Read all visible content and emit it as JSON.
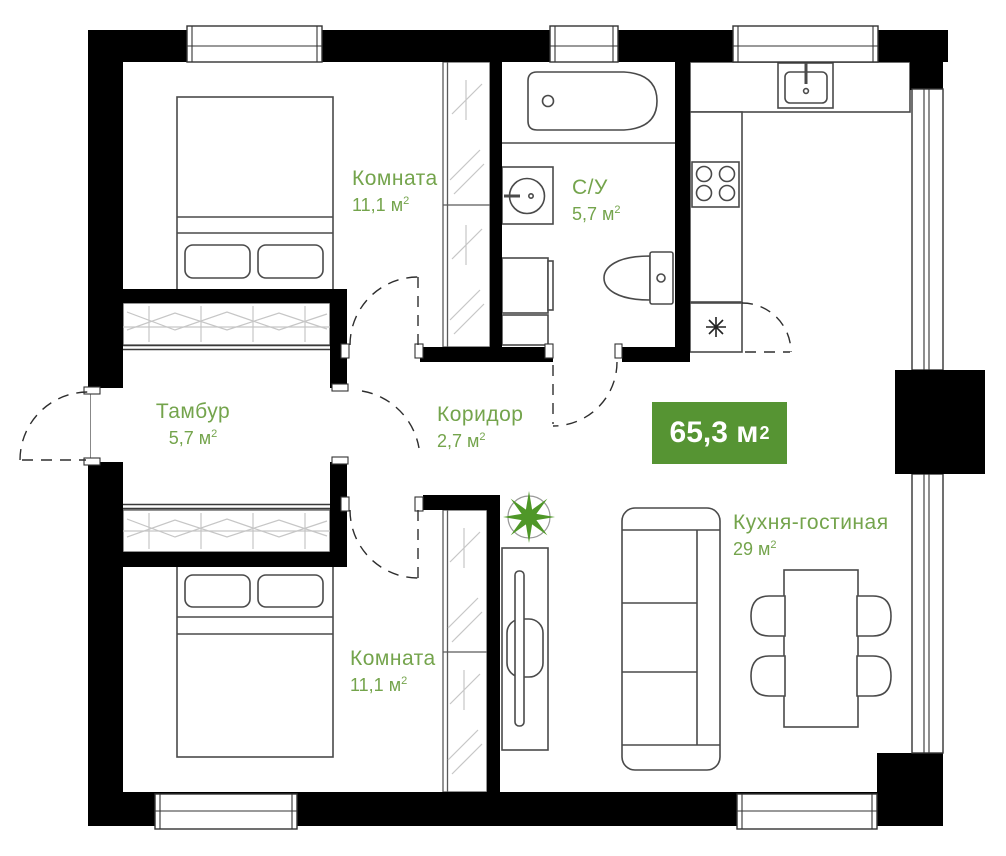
{
  "plan": {
    "title": "apartment-floor-plan",
    "total_area_badge": {
      "value": "65,3 м",
      "sup": "2"
    },
    "rooms": [
      {
        "id": "room-top",
        "name": "Комната",
        "area": "11,1 м",
        "sup": "2"
      },
      {
        "id": "tambur",
        "name": "Тамбур",
        "area": "5,7 м",
        "sup": "2"
      },
      {
        "id": "koridor",
        "name": "Коридор",
        "area": "2,7 м",
        "sup": "2"
      },
      {
        "id": "su",
        "name": "С/У",
        "area": "5,7 м",
        "sup": "2"
      },
      {
        "id": "kitchen",
        "name": "Кухня-гостиная",
        "area": "29 м",
        "sup": "2"
      },
      {
        "id": "room-bottom",
        "name": "Комната",
        "area": "11,1 м",
        "sup": "2"
      }
    ],
    "icons": [
      "plant-icon",
      "snowflake-icon"
    ],
    "colors": {
      "label_green": "#74a44c",
      "badge_green": "#569433",
      "plant_green": "#4f9728",
      "wall_black": "#000000"
    }
  }
}
